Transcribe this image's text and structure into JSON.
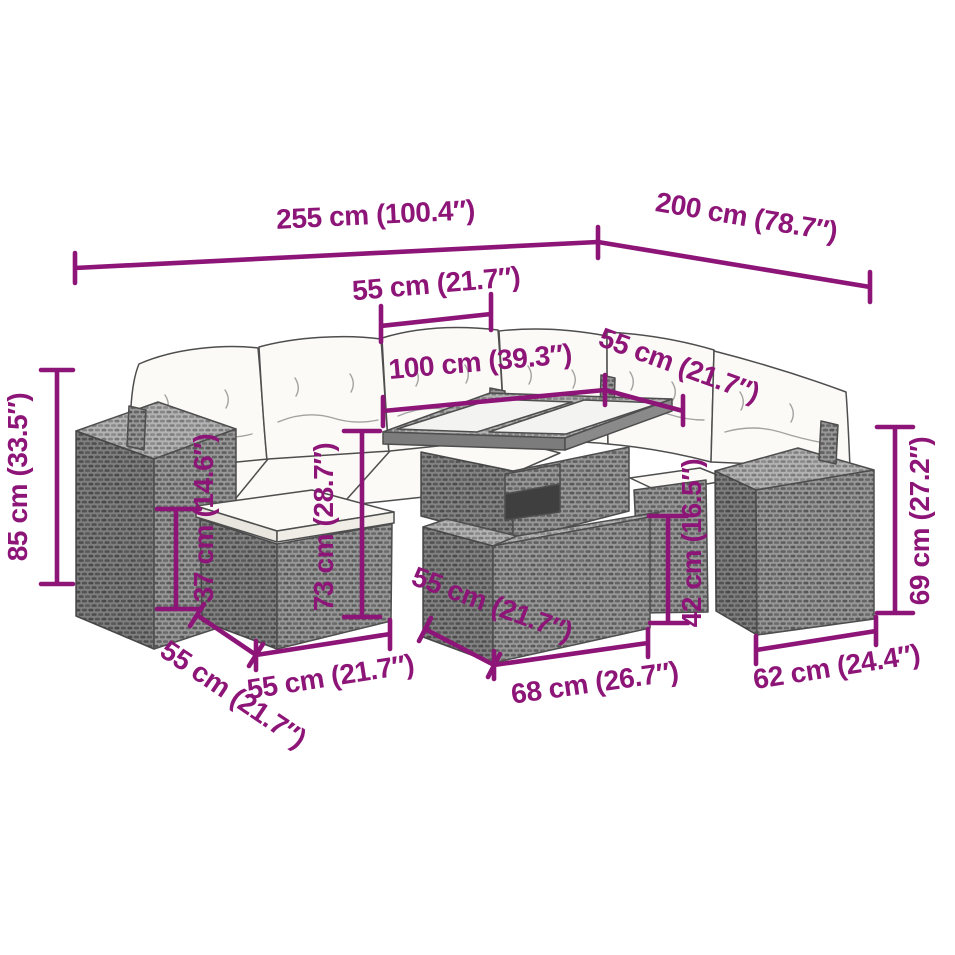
{
  "page": {
    "description": "Dimension diagram of a gray poly rattan garden lounge set with cushions, lift-top table, ottomans and armrest boxes",
    "background": "#ffffff"
  },
  "colors": {
    "dimension_annotation": "#8d1577",
    "rattan_gray": "#979797",
    "rattan_top_gray": "#b3b3b3",
    "cushion_white": "#fbfaf6",
    "outline_gray": "#4e4e4e"
  },
  "dimensions": {
    "total_width": "255 cm (100.4″)",
    "total_depth": "200 cm (78.7″)",
    "backrest_width": "55 cm (21.7″)",
    "tabletop_length": "100 cm (39.3″)",
    "seat_depth_back": "55 cm (21.7″)",
    "sofa_height": "85 cm (33.5″)",
    "footstool_height": "37 cm (14.6″)",
    "table_height": "73 cm (28.7″)",
    "seat_height": "42 cm (16.5″)",
    "armrest_height": "69 cm (27.2″)",
    "footstool_depth": "55 cm (21.7″)",
    "footstool_width": "55 cm (21.7″)",
    "ottoman_depth": "55 cm (21.7″)",
    "ottoman_width": "68 cm (26.7″)",
    "armrest_width": "62 cm (24.4″)"
  }
}
